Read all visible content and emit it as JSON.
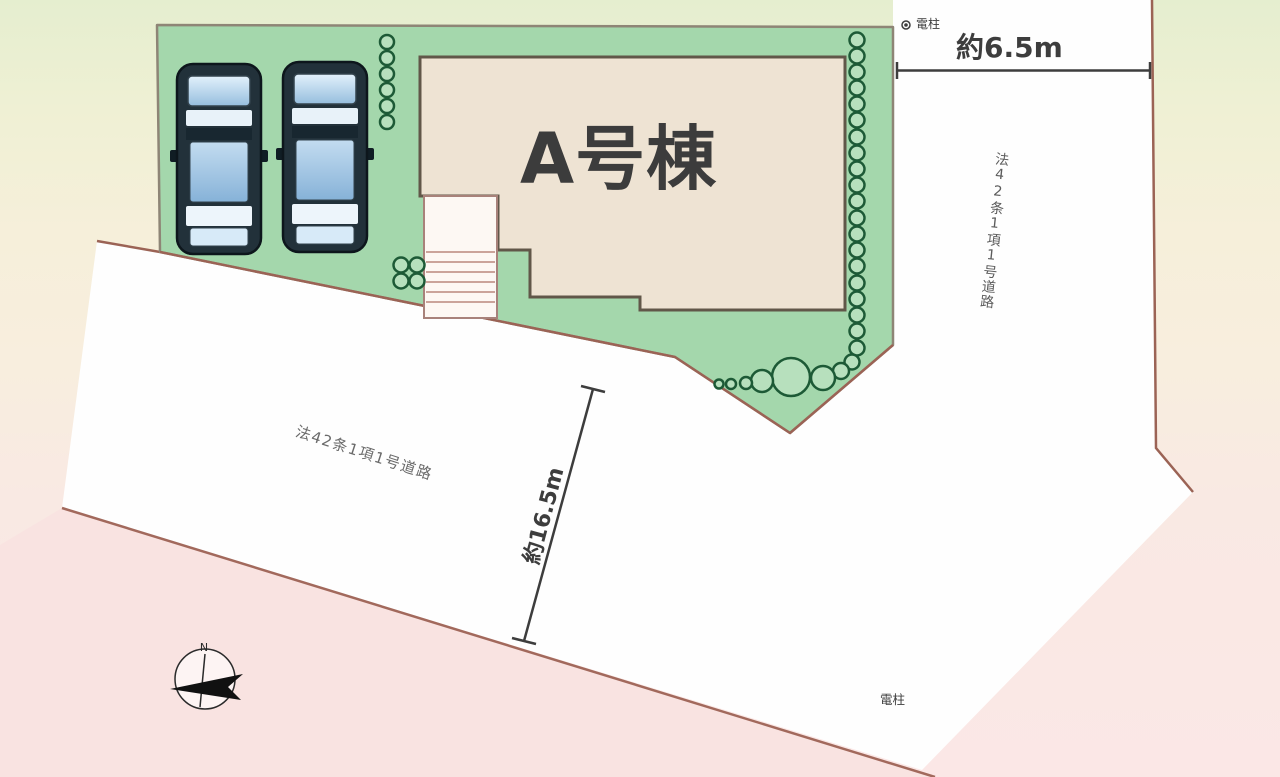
{
  "plan": {
    "building_label": "A号棟",
    "top_dimension": "約6.5m",
    "side_dimension": "約16.5m",
    "right_road_label": "法42条1項1号道路",
    "bottom_road_label": "法42条1項1号道路",
    "top_utility_pole_label": "電柱",
    "bottom_utility_pole_label": "電柱",
    "compass_north_label": "N"
  },
  "colors": {
    "lot_green": "#a4d7ac",
    "hedge_green": "#1d5a36",
    "building_fill": "#eee3d3",
    "building_border": "#615749",
    "road_white": "#fefefe",
    "pink_parcel": "#f9e3e1",
    "boundary_brown": "#9b6355",
    "dimension_dark": "#3d3d3d",
    "car_body": "#22313a",
    "car_glass": "#9cc4e4"
  }
}
